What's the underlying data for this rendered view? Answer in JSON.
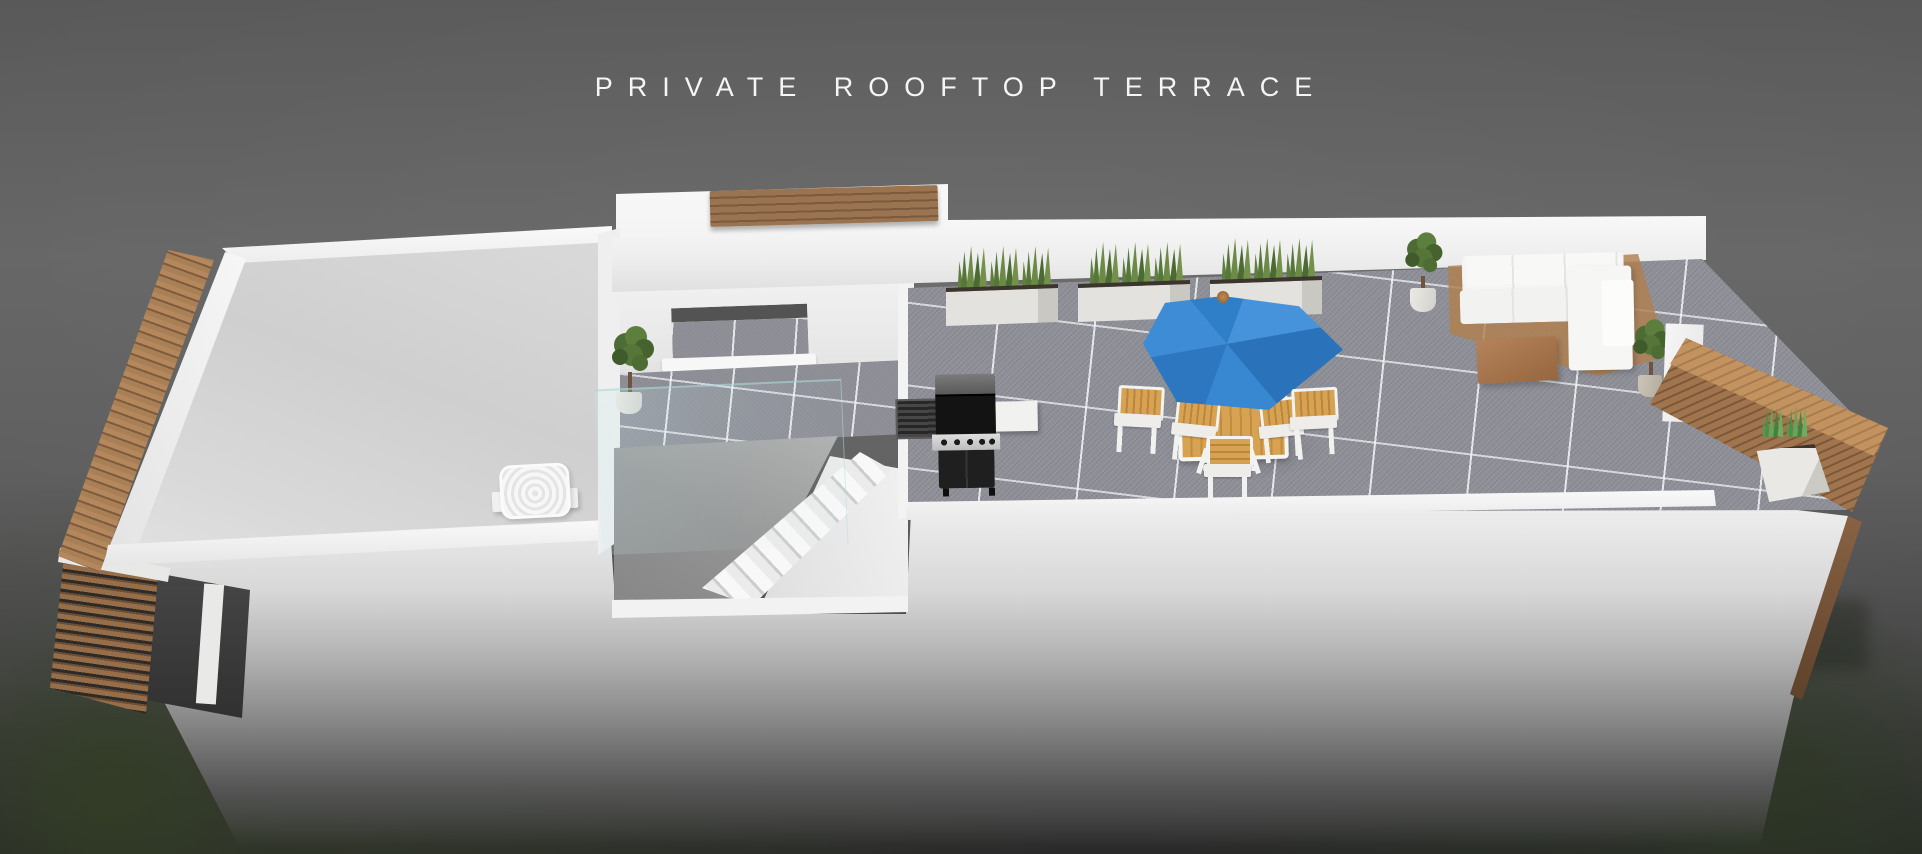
{
  "title": {
    "text": "PRIVATE ROOFTOP TERRACE"
  },
  "scene": {
    "description": "3D cutaway architectural render of a private rooftop terrace on a long flat-roofed building",
    "areas": [
      "plain roof deck with vent",
      "stair bulkhead with window, tree and glass balustrade",
      "tiled terrace"
    ],
    "furniture": [
      "wood slat edge screen",
      "wood parapet bench",
      "roof vent dome",
      "three white planter boxes with snake plants",
      "potted trees",
      "black gas barbecue grill with side shelves",
      "wood and white dining table with four chairs",
      "blue patio umbrella",
      "white modular corner sofa on wood deck base",
      "wood coffee table",
      "corner wood bench with white snake-plant planter"
    ]
  },
  "palette": {
    "background_gray": "#5e5e5e",
    "wall_white": "#f3f3f3",
    "roof_deck_gray": "#d6d6d6",
    "tile_gray": "#8e8f97",
    "wood_tan": "#a97f55",
    "bench_wood_brown": "#8a6344",
    "plant_green": "#5d7d3e",
    "umbrella_blue": "#3181ca",
    "grill_black": "#1d1d1d",
    "glass_tint": "#bfe2e4",
    "grass_dark_green": "#3a4430"
  }
}
